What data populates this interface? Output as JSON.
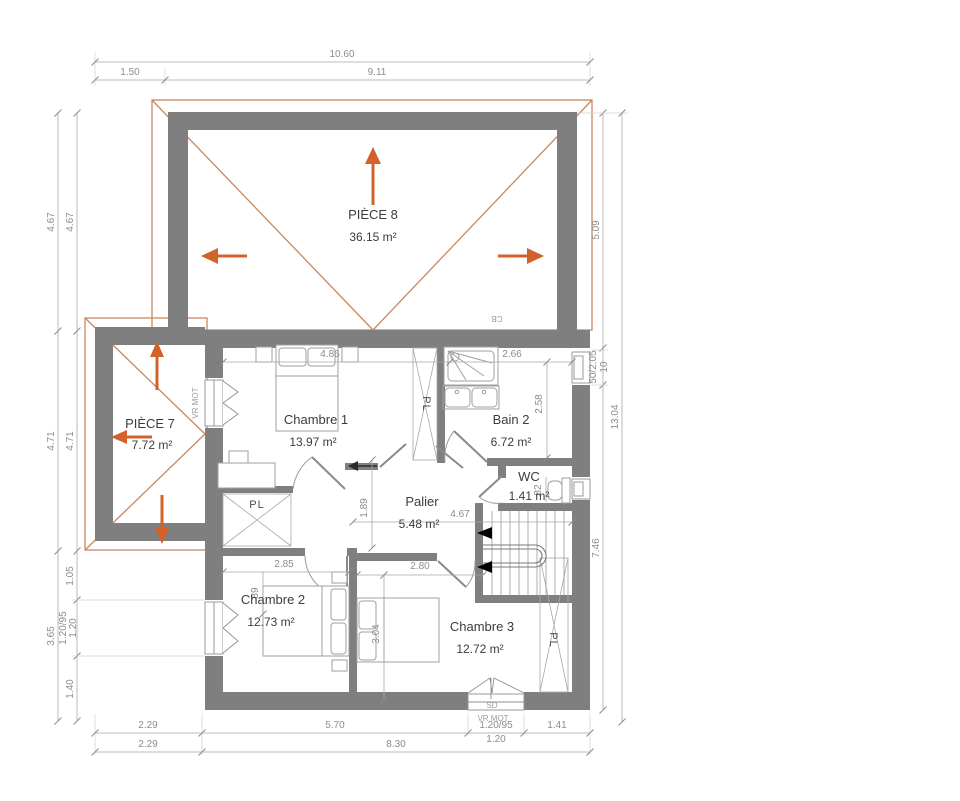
{
  "title": "Plan d'étage",
  "rooms": {
    "piece8": {
      "name": "PIÈCE 8",
      "area": "36.15 m²"
    },
    "piece7": {
      "name": "PIÈCE 7",
      "area": "7.72 m²"
    },
    "chambre1": {
      "name": "Chambre 1",
      "area": "13.97 m²"
    },
    "bain2": {
      "name": "Bain 2",
      "area": "6.72 m²"
    },
    "wc": {
      "name": "WC",
      "area": "1.41 m²"
    },
    "palier": {
      "name": "Palier",
      "area": "5.48 m²"
    },
    "chambre2": {
      "name": "Chambre 2",
      "area": "12.73 m²"
    },
    "chambre3": {
      "name": "Chambre 3",
      "area": "12.72 m²"
    }
  },
  "dims": {
    "top_total": "10.60",
    "top_a": "1.50",
    "top_b": "9.11",
    "left_outer_a": "4.67",
    "left_outer_b": "4.71",
    "left_outer_c": "3.65",
    "left_inner_a": "4.67",
    "left_inner_b": "4.71",
    "left_inner_c": "1.05",
    "left_inner_d": "1.20/95",
    "left_inner_d2": "1.20",
    "left_inner_e": "1.40",
    "right_a": "5.09",
    "right_win": "50/2.05",
    "right_win2": "10",
    "right_b": "7.46",
    "right_total": "13.04",
    "bottom_a": "2.29",
    "bottom_b": "5.70",
    "bottom_win": "1.20/95",
    "bottom_win2": "1.20",
    "bottom_c": "1.41",
    "bottom2_a": "2.29",
    "bottom2_b": "8.30",
    "c1_w": "4.86",
    "bain_w": "2.66",
    "bain_h": "2.58",
    "palier_w": "4.67",
    "palier_h": "1.89",
    "c2_w": "2.85",
    "c2_d": "89",
    "c3_w": "2.80",
    "c3_h": "3.04",
    "wc_d": "82"
  },
  "labels": {
    "pl": "PL",
    "vr_mot": "VR MOT",
    "sd": "SD",
    "cb": "CB"
  },
  "colors": {
    "wall": "#7f7f7f",
    "roof_line": "#c9875f",
    "arrow": "#d2612a",
    "dim_text": "#8c8c8c",
    "room_text": "#3c3c3c"
  }
}
